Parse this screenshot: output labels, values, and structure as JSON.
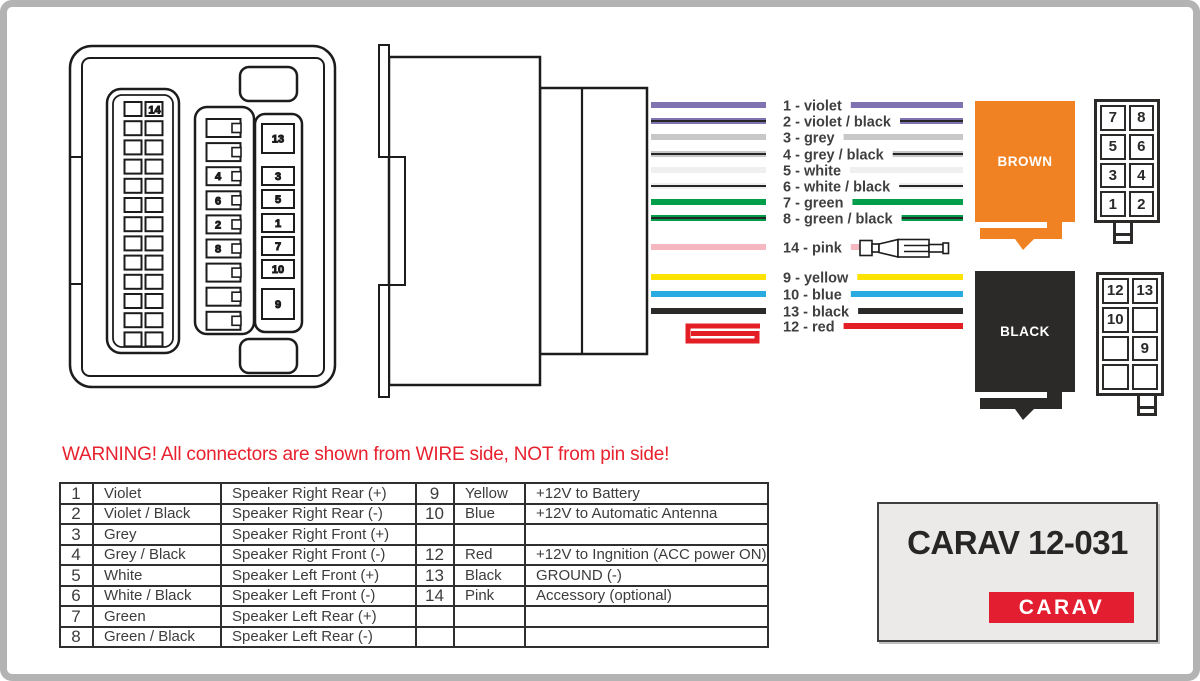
{
  "frame": {
    "border_color": "#b3b3b3",
    "background": "#ffffff"
  },
  "warning": {
    "text": "WARNING! All connectors are shown from WIRE side, NOT from pin side!",
    "color": "#e8212e"
  },
  "branding": {
    "model": "CARAV 12-031",
    "logo_text": "CARAV",
    "logo_bg": "#e31e30",
    "box_bg": "#eceae8"
  },
  "blocks": {
    "brown": {
      "label": "BROWN",
      "fill": "#f08223"
    },
    "black": {
      "label": "BLACK",
      "fill": "#2b2a29"
    }
  },
  "front_view": {
    "left_grid_label": "14",
    "middle_labels": [
      "4",
      "6",
      "2",
      "8"
    ],
    "right_labels": [
      "13",
      "3",
      "5",
      "1",
      "7",
      "10",
      "9"
    ]
  },
  "pin_grids": {
    "brown_grid": [
      "7",
      "8",
      "5",
      "6",
      "3",
      "4",
      "1",
      "2"
    ],
    "black_grid": [
      "12",
      "13",
      "10",
      "",
      "",
      "9",
      "",
      ""
    ]
  },
  "wires": {
    "label_color": "#3f3f3f",
    "to_brown": [
      {
        "num": "1",
        "label": "1 - violet",
        "color": "#8172b2",
        "stripe": false
      },
      {
        "num": "2",
        "label": "2 - violet / black",
        "color": "#8172b2",
        "stripe": true
      },
      {
        "num": "3",
        "label": "3 - grey",
        "color": "#c8c8c8",
        "stripe": false
      },
      {
        "num": "4",
        "label": "4 - grey / black",
        "color": "#c8c8c8",
        "stripe": true
      },
      {
        "num": "5",
        "label": "5 - white",
        "color": "#efefef",
        "stripe": false
      },
      {
        "num": "6",
        "label": "6 - white / black",
        "color": "#efefef",
        "stripe": true
      },
      {
        "num": "7",
        "label": "7 - green",
        "color": "#009e4a",
        "stripe": false
      },
      {
        "num": "8",
        "label": "8 - green / black",
        "color": "#009e4a",
        "stripe": true
      }
    ],
    "accessory": {
      "num": "14",
      "label": "14 - pink",
      "color": "#f5b8c1",
      "stripe": false
    },
    "to_black": [
      {
        "num": "9",
        "label": "9 - yellow",
        "color": "#ffe300",
        "stripe": false
      },
      {
        "num": "10",
        "label": "10 - blue",
        "color": "#29abe2",
        "stripe": false
      },
      {
        "num": "13",
        "label": "13 - black",
        "color": "#2b2a29",
        "stripe": false
      },
      {
        "num": "12",
        "label": "12 - red",
        "color": "#e31e24",
        "stripe": false,
        "folded": true
      }
    ]
  },
  "table": {
    "rows": [
      [
        "1",
        "Violet",
        "Speaker Right Rear (+)",
        "9",
        "Yellow",
        "+12V to Battery"
      ],
      [
        "2",
        "Violet / Black",
        "Speaker Right Rear (-)",
        "10",
        "Blue",
        "+12V to Automatic Antenna"
      ],
      [
        "3",
        "Grey",
        "Speaker Right Front (+)",
        "",
        "",
        ""
      ],
      [
        "4",
        "Grey / Black",
        "Speaker Right Front (-)",
        "12",
        "Red",
        "+12V to Ingnition (ACC power ON)"
      ],
      [
        "5",
        "White",
        "Speaker Left Front (+)",
        "13",
        "Black",
        "GROUND (-)"
      ],
      [
        "6",
        "White / Black",
        "Speaker Left Front (-)",
        "14",
        "Pink",
        "Accessory (optional)"
      ],
      [
        "7",
        "Green",
        "Speaker Left Rear (+)",
        "",
        "",
        ""
      ],
      [
        "8",
        "Green / Black",
        "Speaker Left Rear (-)",
        "",
        "",
        ""
      ]
    ]
  }
}
